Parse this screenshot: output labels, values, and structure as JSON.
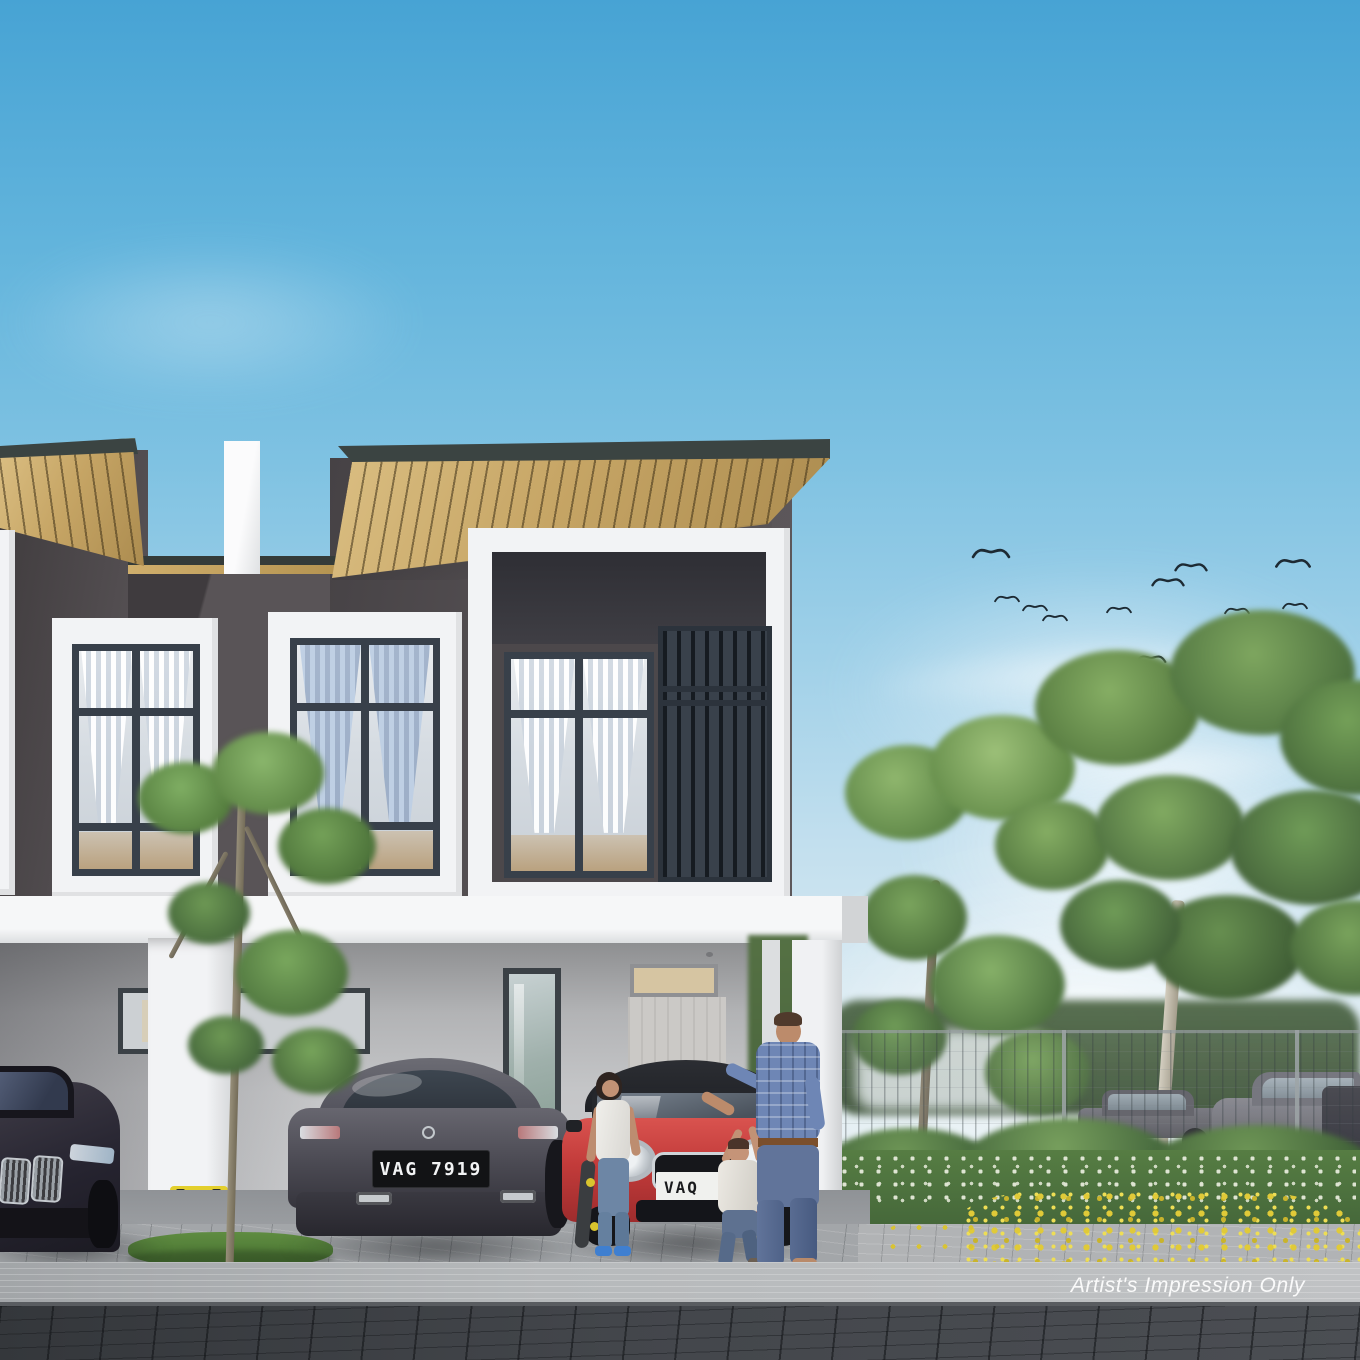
{
  "meta": {
    "title": "Two-storey terrace house — artist's impression",
    "type": "architectural-rendering"
  },
  "overlay": {
    "watermark": "Artist's Impression Only"
  },
  "vehicles": {
    "carporch": [
      {
        "label": "black luxury sedan",
        "plate": ""
      },
      {
        "label": "grey coupe",
        "plate": "VAG 7919"
      },
      {
        "label": "red mini hatchback",
        "plate": "VAQ"
      }
    ],
    "street": [
      {
        "label": "grey hatchback"
      },
      {
        "label": "grey coupe"
      },
      {
        "label": "dark sedan"
      }
    ]
  },
  "people": [
    {
      "label": "girl holding skateboard"
    },
    {
      "label": "toddler walking"
    },
    {
      "label": "father in plaid shirt"
    }
  ],
  "environment": {
    "birds_count": 14,
    "trees": [
      "young street tree",
      "garden tree",
      "large roadside tree"
    ],
    "hedge_flowers": "yellow daylilies",
    "sky": "clear blue with wispy clouds"
  },
  "palette": {
    "sky_top": "#47a3d4",
    "facade_dark": "#565154",
    "roof_fascia": "#3b4442",
    "soffit_wood": "#c6a565",
    "trim_white": "#f2f3f5",
    "wall_ground": "#bdbec0",
    "car_red": "#c23b3a",
    "car_grey": "#5e5d65",
    "car_black": "#2b2833",
    "foliage": "#6f9b57",
    "flower_yellow": "#d9c434",
    "road": "#43464b"
  }
}
